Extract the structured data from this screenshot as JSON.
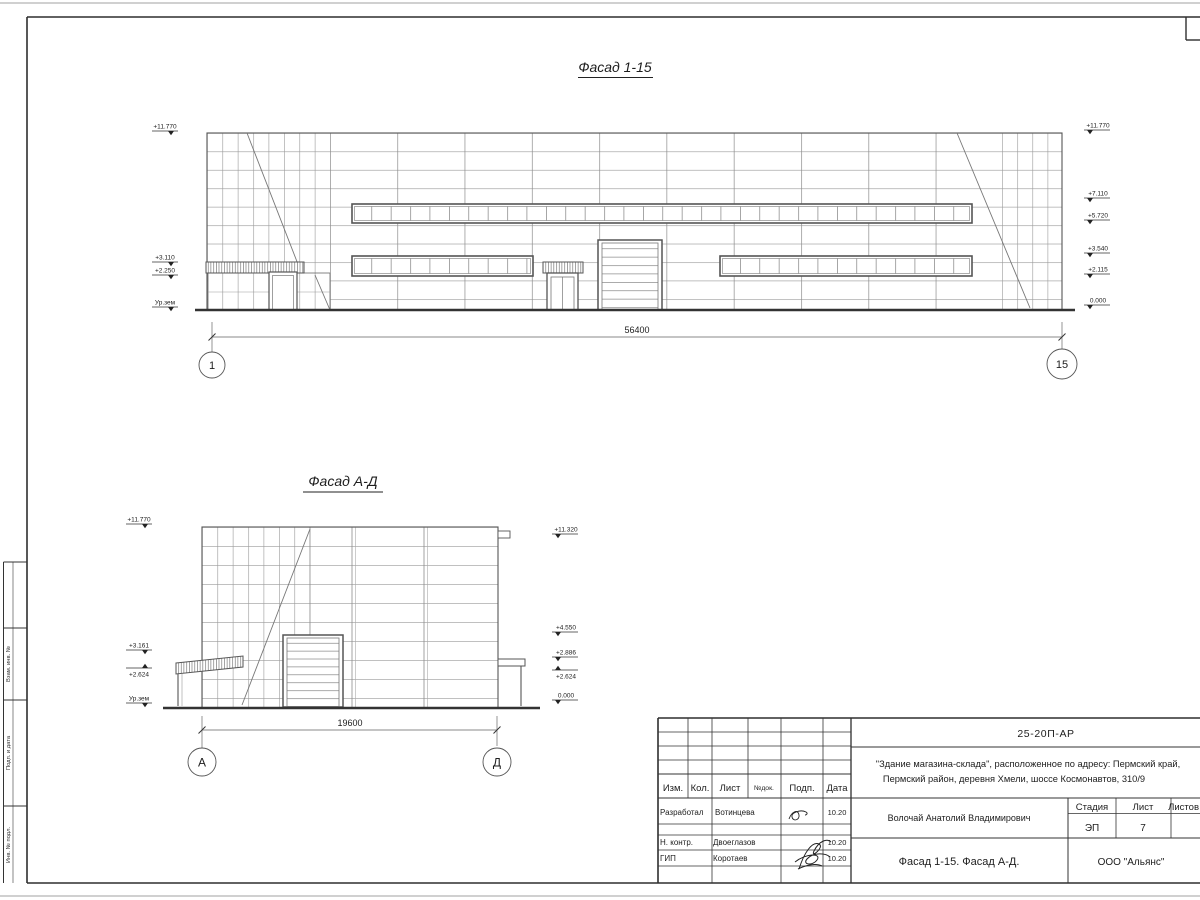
{
  "sheet": {
    "side_stamp_labels": [
      "Взам. инв. №",
      "Подп. и дата",
      "Инв. № подл."
    ]
  },
  "facade1": {
    "title": "Фасад 1-15",
    "dim": "56400",
    "axis_start": "1",
    "axis_end": "15",
    "marks_left": [
      "+11.770",
      "+3.110",
      "+2.250",
      "Ур.зем"
    ],
    "marks_right": [
      "+11.770",
      "+7.110",
      "+5.720",
      "+3.540",
      "+2.115",
      "0.000"
    ]
  },
  "facade2": {
    "title": "Фасад А-Д",
    "dim": "19600",
    "axis_start": "А",
    "axis_end": "Д",
    "marks_left": [
      "+11.770",
      "+3.161",
      "+2.624",
      "Ур.зем"
    ],
    "marks_right": [
      "+11.320",
      "+4.550",
      "+2.886",
      "+2.624",
      "0.000"
    ]
  },
  "title_block": {
    "doc_number": "25-20П-АР",
    "object_line1": "\"Здание магазина-склада\", расположенное по адресу: Пермский край,",
    "object_line2": "Пермский район, деревня Хмели, шоссе Космонавтов, 310/9",
    "col_izm": "Изм.",
    "col_kol": "Кол.",
    "col_list": "Лист",
    "col_ndoc": "№док.",
    "col_podp": "Подп.",
    "col_data": "Дата",
    "row1_role": "Разработал",
    "row1_name": "Вотинцева",
    "row1_date": "10.20",
    "row2_role": "Н. контр.",
    "row2_name": "Двоеглазов",
    "row2_date": "10.20",
    "row3_role": "ГИП",
    "row3_name": "Коротаев",
    "row3_date": "10.20",
    "chief_name": "Волочай Анатолий Владимирович",
    "stage_label": "Стадия",
    "sheet_label": "Лист",
    "sheets_label": "Листов",
    "stage_value": "ЭП",
    "sheet_value": "7",
    "drawing_title": "Фасад 1-15. Фасад А-Д.",
    "company": "ООО \"Альянс\""
  }
}
